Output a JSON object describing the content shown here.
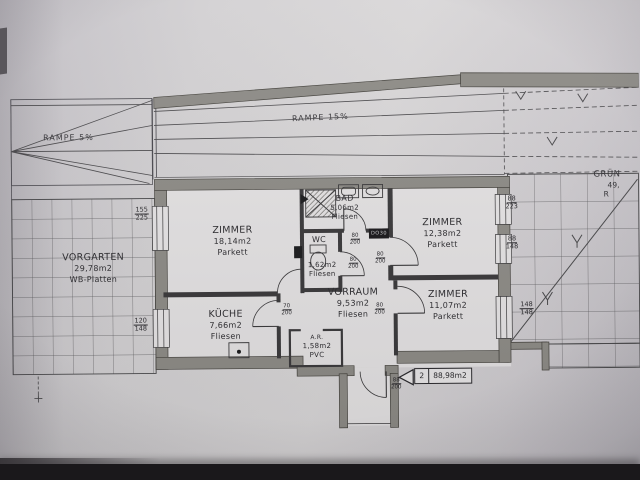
{
  "colors": {
    "paper": "#d5d3d5",
    "ink": "#3b3a3c",
    "wall": "#8e8c87",
    "shadow_bar": "#1a181b"
  },
  "plan": {
    "ramps": {
      "left": "RAMPE 5%",
      "main": "RAMPE 15%"
    },
    "rooms": {
      "vorgarten": {
        "name": "VORGARTEN",
        "area": "29,78m2",
        "floor": "WB-Platten"
      },
      "zimmer1": {
        "name": "ZIMMER",
        "area": "18,14m2",
        "floor": "Parkett"
      },
      "bad": {
        "name": "BAD",
        "area": "5,06m2",
        "floor": "Fliesen"
      },
      "zimmer2": {
        "name": "ZIMMER",
        "area": "12,38m2",
        "floor": "Parkett"
      },
      "wc": {
        "name": "WC",
        "area": "1,62m2",
        "floor": "Fliesen"
      },
      "vorraum": {
        "name": "VORRAUM",
        "area": "9,53m2",
        "floor": "Fliesen"
      },
      "kueche": {
        "name": "KÜCHE",
        "area": "7,66m2",
        "floor": "Fliesen"
      },
      "abstellraum": {
        "name": "A.R.",
        "area": "1,58m2",
        "floor": "PVC"
      },
      "zimmer3": {
        "name": "ZIMMER",
        "area": "11,07m2",
        "floor": "Parkett"
      },
      "gruenflaeche": {
        "name": "GRÜN",
        "area": "49,",
        "floor": "R"
      }
    },
    "window_dims": {
      "left_top": {
        "w": "155",
        "h": "225"
      },
      "left_bottom": {
        "w": "120",
        "h": "148"
      },
      "right_top": {
        "w": "88",
        "h": "223"
      },
      "right_mid": {
        "w": "88",
        "h": "148"
      },
      "right_bottom": {
        "w": "148",
        "h": "148"
      }
    },
    "door_dims": {
      "bad": {
        "w": "80",
        "h": "200"
      },
      "wc": {
        "w": "80",
        "h": "200"
      },
      "zimmer2": {
        "w": "80",
        "h": "200"
      },
      "zimmer3": {
        "w": "80",
        "h": "200"
      },
      "kueche": {
        "w": "70",
        "h": "200"
      },
      "entry": {
        "w": "88",
        "h": "200"
      }
    },
    "unit_tag": {
      "number": "2",
      "area": "88,98m2"
    },
    "equipment": {
      "bad_box": "DO30"
    }
  }
}
